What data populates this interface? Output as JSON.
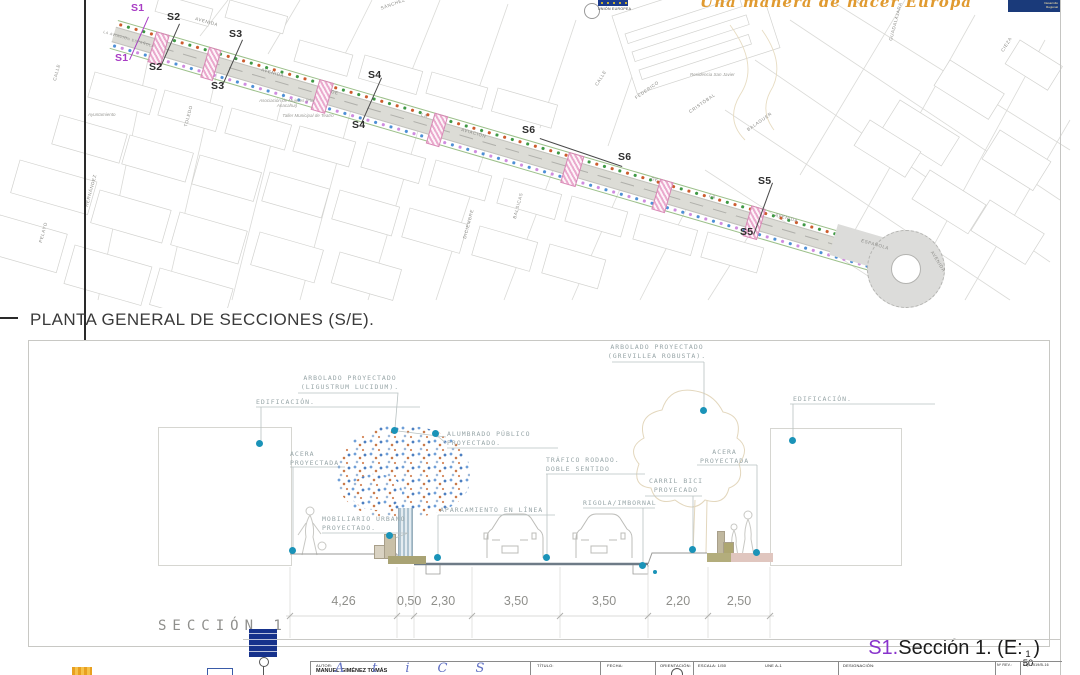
{
  "header": {
    "motto": "Una manera de hacer Europa",
    "eu_flag_caption": "UNIÓN EUROPEA",
    "right_logo_line1": "Desarrollo",
    "right_logo_line2": "Regional"
  },
  "plan": {
    "title": "PLANTA GENERAL DE SECCIONES (S/E).",
    "marker_color_s1": "#a83cc4",
    "marker_color_default": "#3c3c3c",
    "markers": [
      {
        "label": "S1"
      },
      {
        "label": "S2"
      },
      {
        "label": "S3"
      },
      {
        "label": "S4"
      },
      {
        "label": "S6"
      },
      {
        "label": "S5"
      }
    ],
    "street_labels": [
      "AVENIDA",
      "LA AVIACIÓN ESPAÑOLA",
      "AVENIDA",
      "DE",
      "LA",
      "AVIACIÓN",
      "DE",
      "LA",
      "AVENIDA",
      "ESPAÑOLA",
      "AVENIDA",
      "CALLE",
      "FEDERICO",
      "CRISTÓBAL",
      "BALAGUER",
      "SÁNCHEZ",
      "CASERÍO",
      "GUADALAJARA",
      "CIEZA",
      "TOLEDO",
      "HERNÁNDEZ",
      "PELAYO",
      "DICIEMBRE",
      "BALSICAS",
      "CALLE"
    ],
    "place_labels": [
      "Residencia San Javier",
      "Ayuntamiento",
      "Asociación de Mujeres (Flor Anacahui)",
      "Taller Municipal de Teatro"
    ]
  },
  "section": {
    "name": "SECCIÓN 1",
    "caption": {
      "ref": "S1.",
      "text": "Sección 1. (E:",
      "num": "1",
      "den": "50",
      "close": ")"
    },
    "labels": {
      "arbolado_left_1": "ARBOLADO PROYECTADO",
      "arbolado_left_2": "(LIGUSTRUM LUCIDUM).",
      "edificacion_left": "EDIFICACIÓN.",
      "alumbrado_1": "ALUMBRADO PÚBLICO",
      "alumbrado_2": "PROYECTADO.",
      "acera_left_1": "ACERA",
      "acera_left_2": "PROYECTADA",
      "arbolado_right_1": "ARBOLADO PROYECTADO",
      "arbolado_right_2": "(GREVILLEA ROBUSTA).",
      "edificacion_right": "EDIFICACIÓN.",
      "acera_right_1": "ACERA",
      "acera_right_2": "PROYECTADA",
      "trafico_1": "TRÁFICO RODADO.",
      "trafico_2": "DOBLE SENTIDO",
      "carril_1": "CARRIL BICI",
      "carril_2": "PROYECADO",
      "rigola": "RIGOLA/IMBORNAL",
      "aparcamiento": "APARCAMIENTO EN LÍNEA",
      "mobiliario_1": "MOBILIARIO URBANO",
      "mobiliario_2": "PROYECTADO."
    },
    "dimensions": [
      "4,26",
      "0,50",
      "2,30",
      "3,50",
      "3,50",
      "2,20",
      "2,50"
    ],
    "dot_color": "#1a93b8"
  },
  "titleblock": {
    "autor_label": "AUTOR:",
    "autor": "MANUEL GIMÉNEZ TOMÁS",
    "titulo_label": "TÍTULO:",
    "fecha_label": "FECHA:",
    "orientacion_label": "ORIENTACIÓN:",
    "escala": "ESCALA: 1/50",
    "formato": "UNE A-1",
    "designacion_label": "DESIGNACIÓN:",
    "nrev_label": "Nº REV.:",
    "exp": "Exp 1519/B-16",
    "signature": "AtiCS"
  }
}
